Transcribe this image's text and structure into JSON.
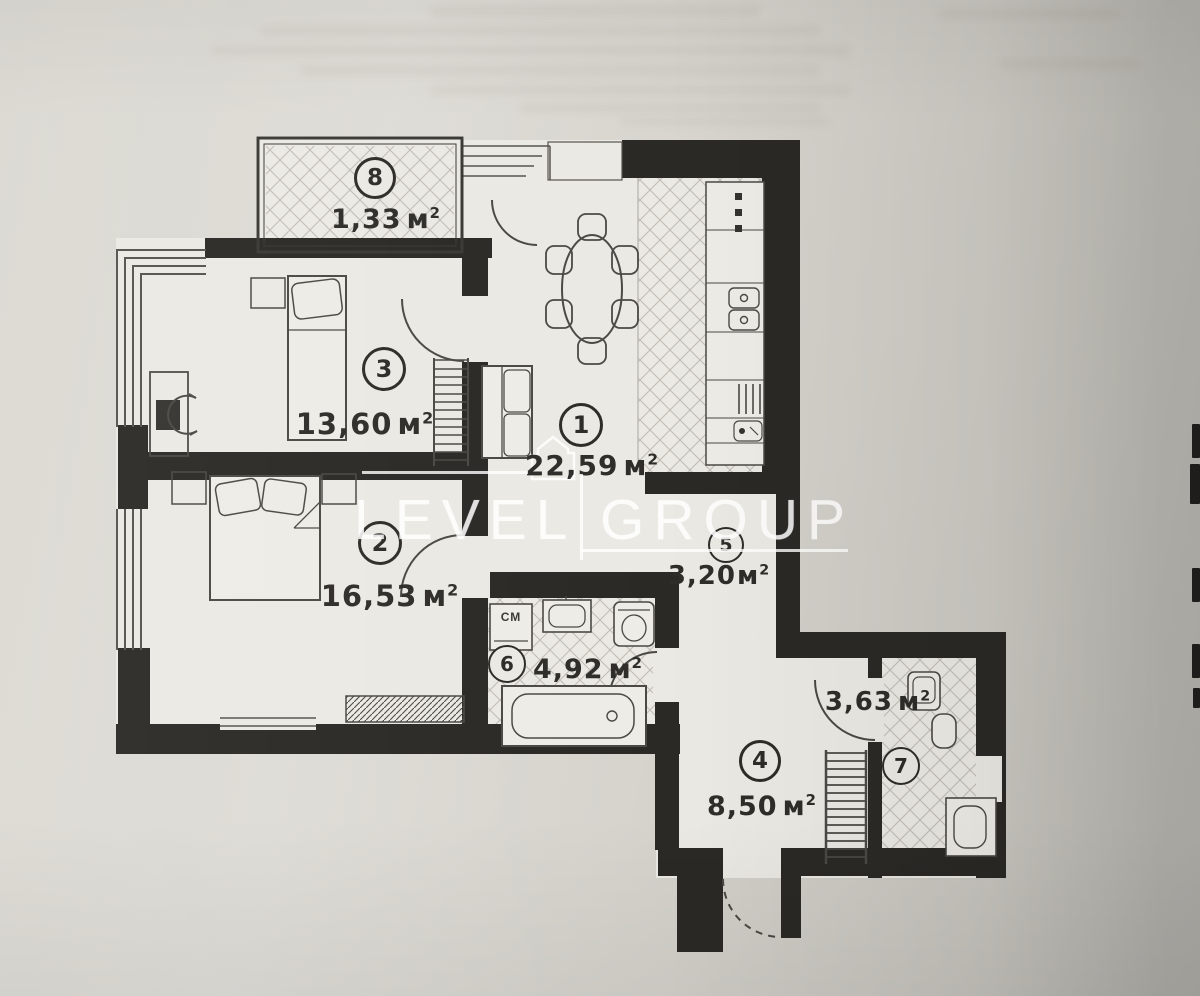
{
  "document": {
    "kind": "apartment-floor-plan-photo"
  },
  "watermark": {
    "left": "LEVEL",
    "right": "GROUP"
  },
  "units": {
    "base": "м",
    "sup": "2"
  },
  "rooms": [
    {
      "number": "1",
      "area": "22,59"
    },
    {
      "number": "2",
      "area": "16,53"
    },
    {
      "number": "3",
      "area": "13,60"
    },
    {
      "number": "4",
      "area": "8,50"
    },
    {
      "number": "5",
      "area": "3,20"
    },
    {
      "number": "6",
      "area": "4,92"
    },
    {
      "number": "7",
      "area": "3,63"
    },
    {
      "number": "8",
      "area": "1,33"
    }
  ],
  "labels": {
    "washing_machine": "СМ"
  }
}
